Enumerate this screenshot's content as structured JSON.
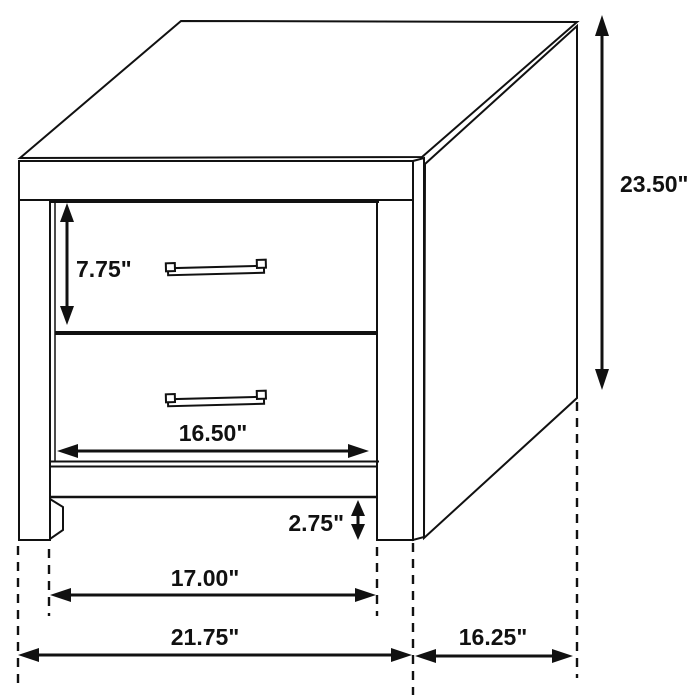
{
  "canvas": {
    "background": "#ffffff",
    "line_color": "#111111"
  },
  "dimensions": {
    "overall_height": "23.50\"",
    "top_drawer_height": "7.75\"",
    "drawer_width": "16.50\"",
    "base_clearance": "2.75\"",
    "inner_leg_width": "17.00\"",
    "overall_width": "21.75\"",
    "overall_depth": "16.25\""
  }
}
